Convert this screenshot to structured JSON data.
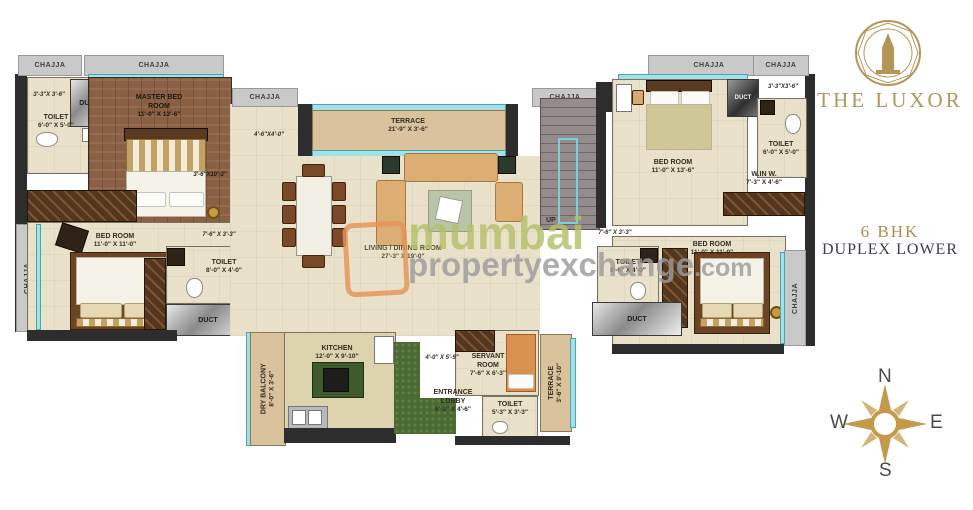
{
  "branding": {
    "title": "THE LUXOR",
    "type_line1": "6 BHK",
    "type_line2": "DUPLEX LOWER"
  },
  "watermark": {
    "word1": "mumbai",
    "word2": "propertyexchange",
    "word3": ".com"
  },
  "compass": {
    "north": "N",
    "east": "E",
    "south": "S",
    "west": "W"
  },
  "common": {
    "chajja": "CHAJJA",
    "duct": "DUCT",
    "up": "UP"
  },
  "rooms": {
    "master_bedroom": {
      "name": "MASTER BED ROOM",
      "dims": "11'-0\" X 13'-6\""
    },
    "bedroom_left": {
      "name": "BED ROOM",
      "dims": "11'-0\" X 11'-0\""
    },
    "bedroom_right_top": {
      "name": "BED ROOM",
      "dims": "11'-0\" X 13'-6\""
    },
    "bedroom_right_bottom": {
      "name": "BED ROOM",
      "dims": "11'-0\" X 11'-0\""
    },
    "living_dining": {
      "name": "LIVING / DINING ROOM",
      "dims": "27'-3\" X 19'-0\""
    },
    "terrace_top": {
      "name": "TERRACE",
      "dims": "21'-9\" X 3'-6\""
    },
    "terrace_bottom": {
      "name": "TERRACE",
      "dims": "3'-6\" X 9'-10\""
    },
    "dry_balcony": {
      "name": "DRY BALCONY",
      "dims": "8'-0\" X 3'-6\""
    },
    "kitchen": {
      "name": "KITCHEN",
      "dims": "12'-0\" X 9'-10\""
    },
    "entrance_lobby": {
      "name": "ENTRANCE LOBBY",
      "dims": "6'-3\" X 4'-6\""
    },
    "servant_room": {
      "name": "SERVANT ROOM",
      "dims": "7'-6\" X 6'-3\""
    },
    "walk_in_wardrobe": {
      "name": "W.IN W.",
      "dims": "7'-3\" X 4'-6\""
    },
    "toilet_top_left": {
      "name": "TOILET",
      "dims": "6'-0\" X 5'-0\""
    },
    "toilet_left": {
      "name": "TOILET",
      "dims": "8'-0\" X 4'-0\""
    },
    "toilet_top_right": {
      "name": "TOILET",
      "dims": "6'-0\" X 5'-0\""
    },
    "toilet_right": {
      "name": "TOILET",
      "dims": "8'-0\" X 4'-0\""
    },
    "toilet_servant": {
      "name": "TOILET",
      "dims": "5'-3\" X 3'-3\""
    }
  },
  "passages": {
    "nook_top_left": "3'-3\"X 3'-6\"",
    "nook_top_right": "3'-3\"X3'-6\"",
    "beside_terrace": "4'-6\"X4'-0\"",
    "beside_master": "3'-6\"X10'-3\"",
    "left_corridor": "7'-6\" X 3'-3\"",
    "right_corridor": "7'-6\" X 3'-3\"",
    "kitchen_passage": "4'-0\" X 5'-9\""
  }
}
